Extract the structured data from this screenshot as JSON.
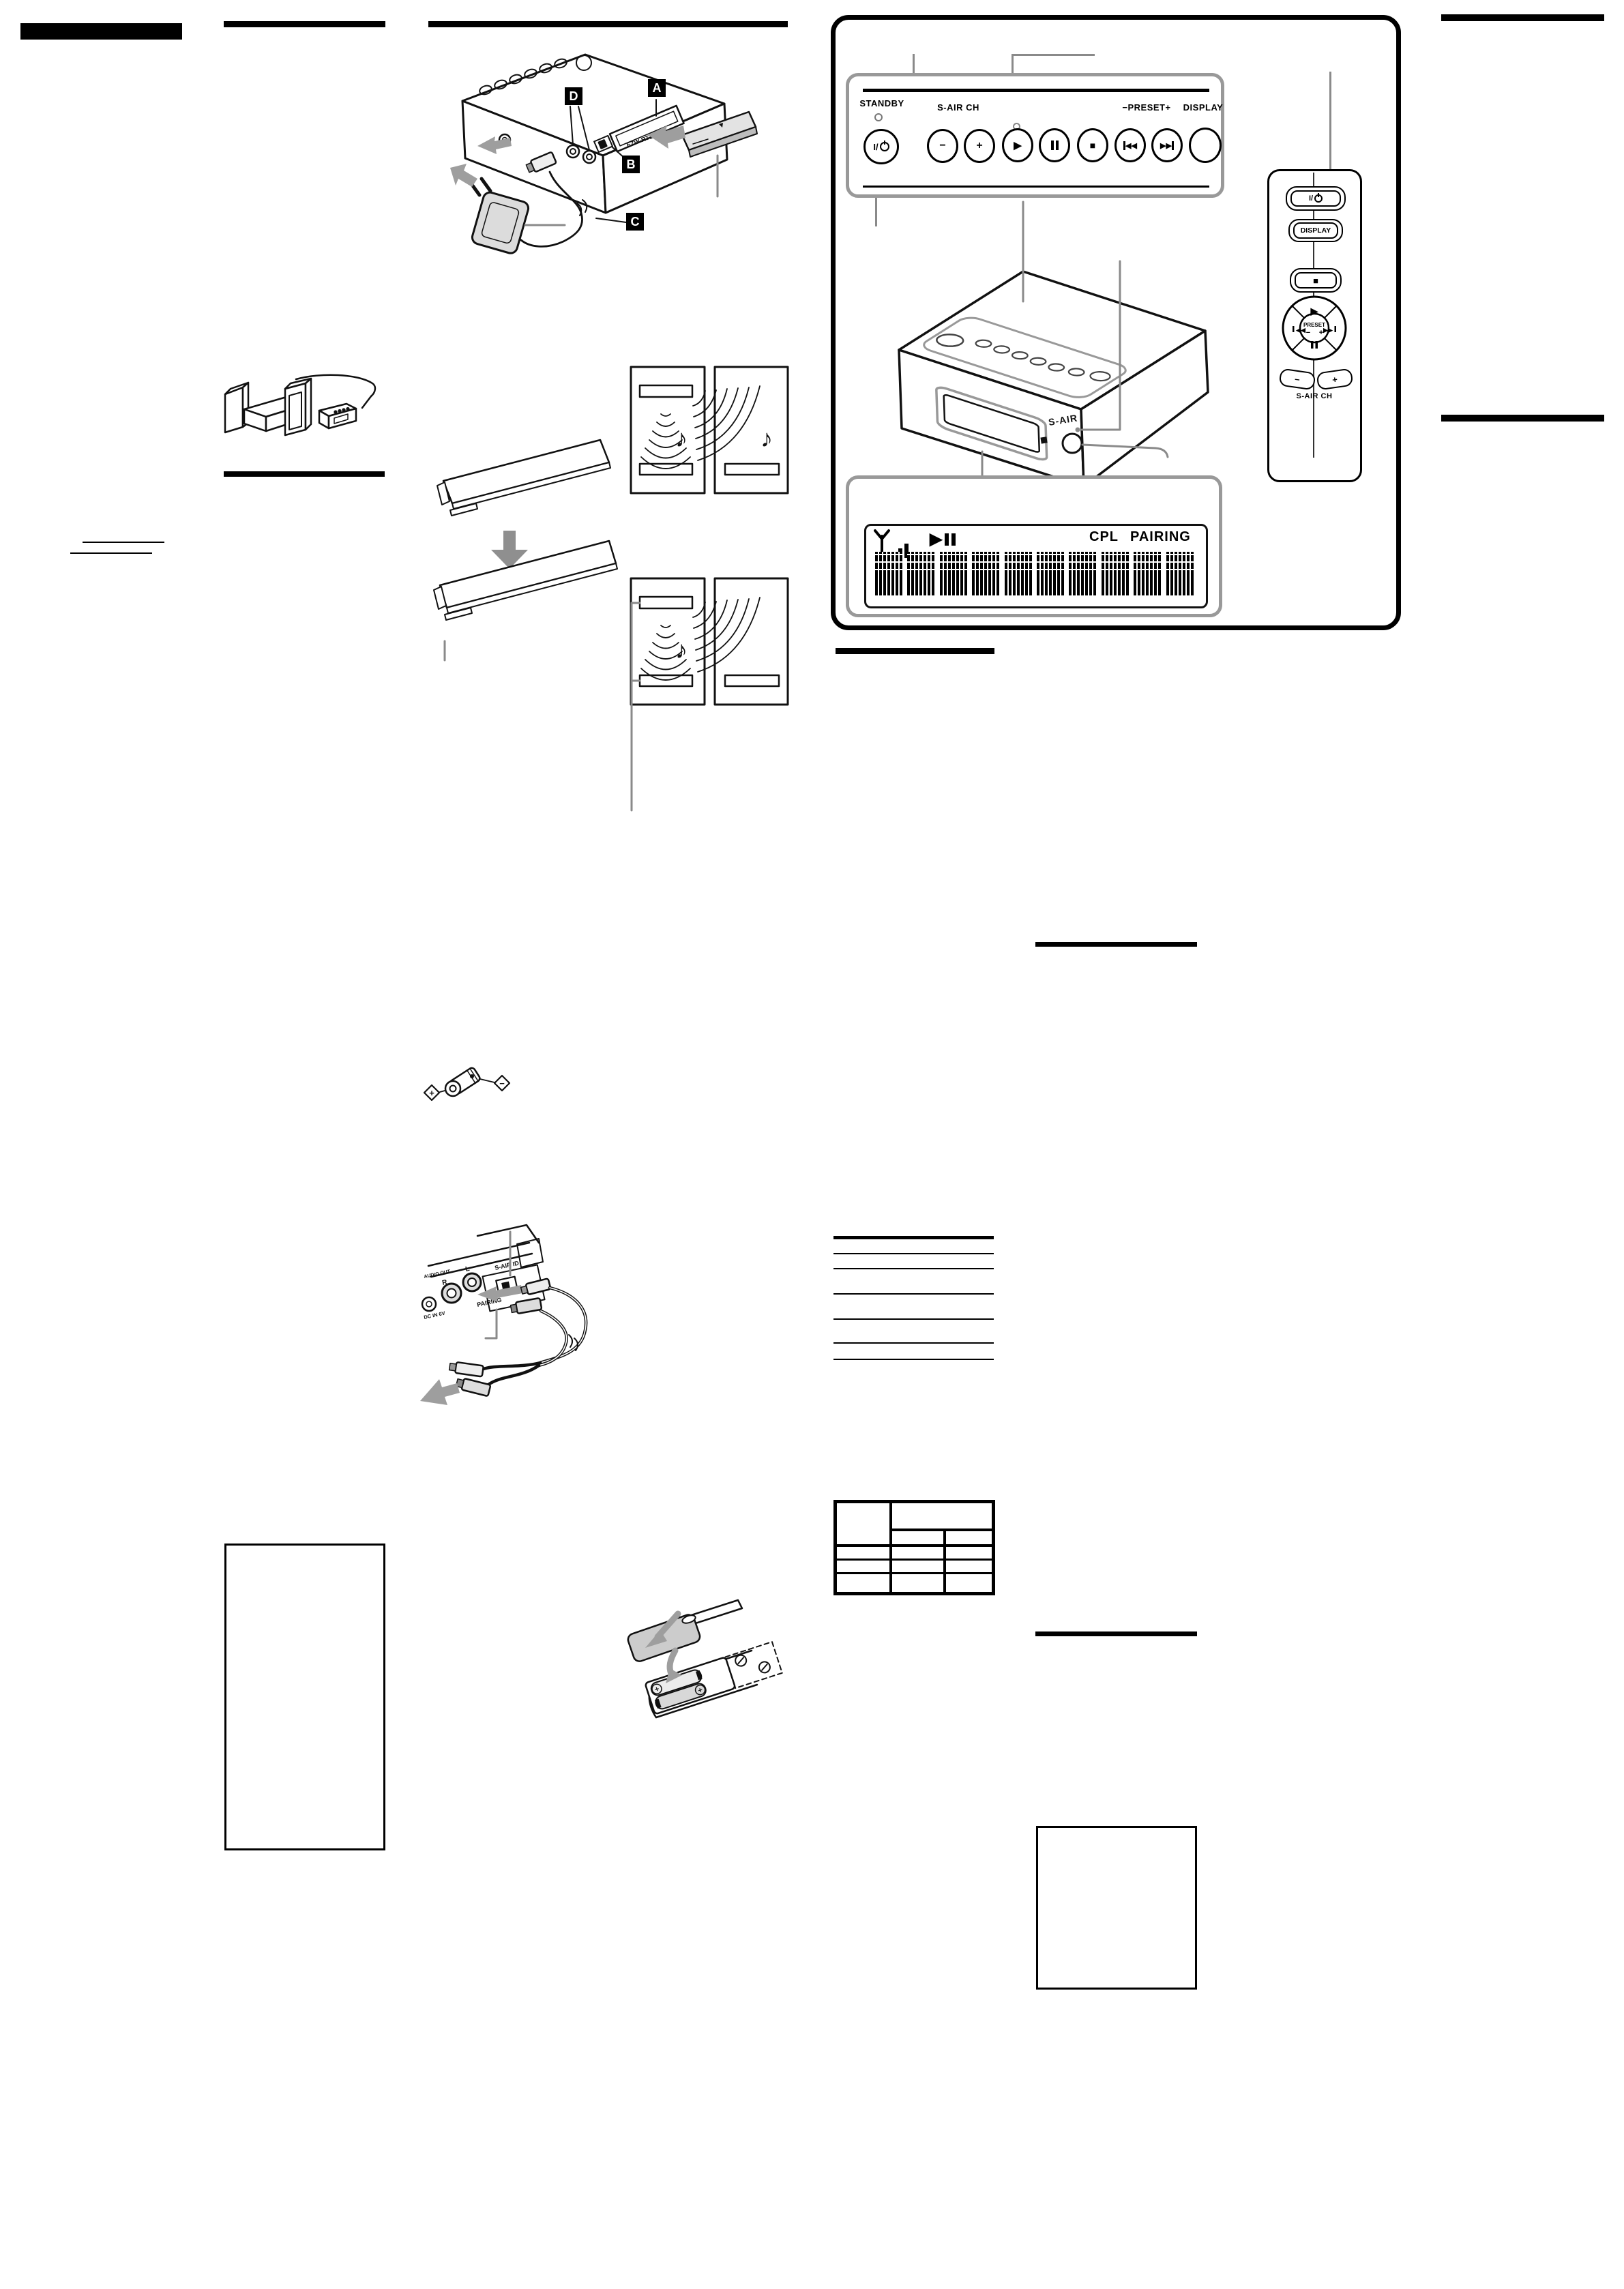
{
  "document": {
    "kind": "scanned instruction manual page"
  },
  "colors": {
    "ink": "#000000",
    "callout_gray": "#8a8a8a",
    "panel_border_gray": "#999999",
    "fill_gray": "#d9d9d9",
    "arrow_gray": "#9e9e9e"
  },
  "front_panel": {
    "standby_label": "STANDBY",
    "power_label": "I/",
    "sair_ch_label": "S-AIR CH",
    "preset_label": "−PRESET+",
    "display_label": "DISPLAY",
    "minus": "−",
    "plus": "+",
    "play_icon": "▶",
    "stop_icon": "■",
    "prev_icon": "◀◀",
    "next_icon": "▶▶"
  },
  "display_panel": {
    "cpl_indicator": "CPL",
    "pairing_indicator": "PAIRING",
    "play_icon": "▶"
  },
  "main_unit": {
    "sair_logo": "S-AIR"
  },
  "rear_unit": {
    "slot_label": "EZW-RT10A",
    "callout_a": "A",
    "callout_b": "B",
    "callout_c": "C",
    "callout_d": "D"
  },
  "remote": {
    "power_label": "I/",
    "display_label": "DISPLAY",
    "stop_icon": "■",
    "play_icon": "▶",
    "prev_icon": "◀◀",
    "next_icon": "▶▶",
    "preset_label": "PRESET",
    "minus": "−",
    "plus": "+",
    "sair_ch_label": "S-AIR CH"
  },
  "rear_jacks": {
    "audio_out": "AUDIO OUT",
    "right": "R",
    "left": "L",
    "sair_id": "S-AIR ID",
    "pairing": "PAIRING",
    "dc_in": "DC IN 6V"
  },
  "battery": {
    "plus": "+"
  },
  "polarity": {
    "plus": "+",
    "minus": "−"
  },
  "rooms": {
    "note": "♪"
  }
}
